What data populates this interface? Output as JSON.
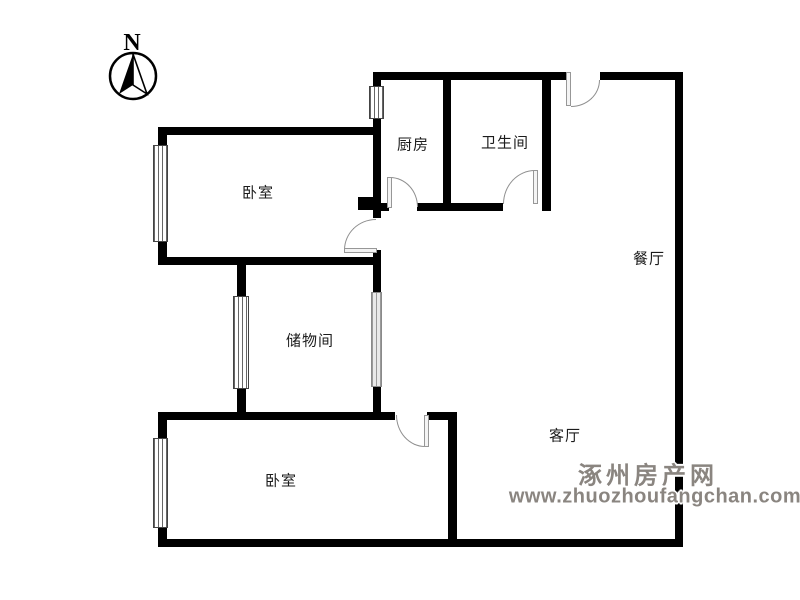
{
  "compass": {
    "letter": "N"
  },
  "rooms": [
    {
      "id": "bedroom-top",
      "label": "卧室"
    },
    {
      "id": "kitchen",
      "label": "厨房"
    },
    {
      "id": "bathroom",
      "label": "卫生间"
    },
    {
      "id": "dining",
      "label": "餐厅"
    },
    {
      "id": "storage",
      "label": "储物间"
    },
    {
      "id": "living",
      "label": "客厅"
    },
    {
      "id": "bedroom-bottom",
      "label": "卧室"
    }
  ],
  "watermark": {
    "site_name": "涿州房产网",
    "url": "www.zhuozhoufangchan.com",
    "color": "#8a8580"
  }
}
